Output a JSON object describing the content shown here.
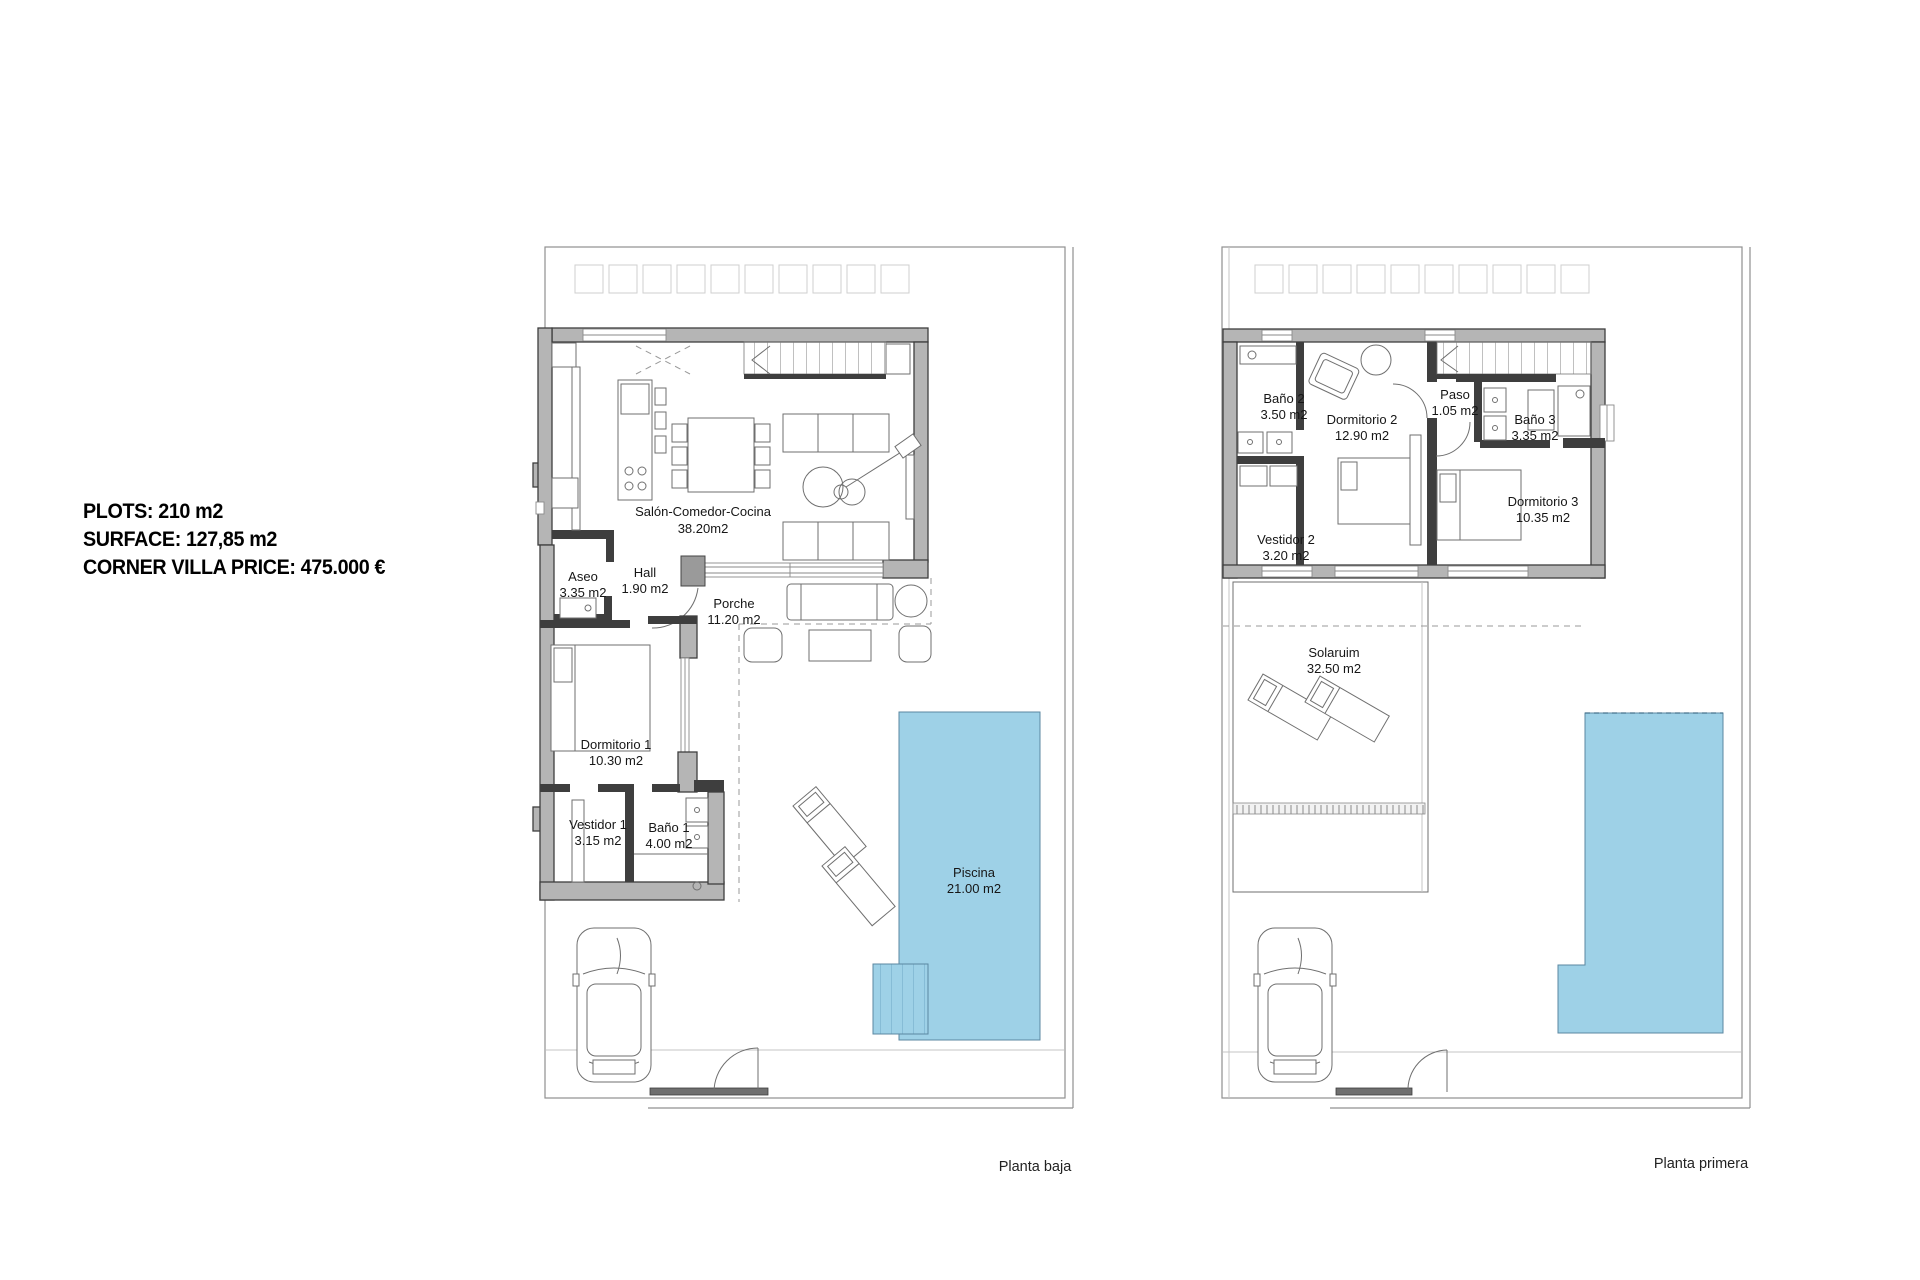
{
  "info": {
    "plots": "PLOTS: 210 m2",
    "surface": "SURFACE: 127,85 m2",
    "price": "CORNER VILLA PRICE: 475.000 €"
  },
  "ground_floor": {
    "caption": "Planta baja",
    "rooms": {
      "salon": {
        "name": "Salón-Comedor-Cocina",
        "area": "38.20m2"
      },
      "aseo": {
        "name": "Aseo",
        "area": "3.35 m2"
      },
      "hall": {
        "name": "Hall",
        "area": "1.90 m2"
      },
      "porche": {
        "name": "Porche",
        "area": "11.20 m2"
      },
      "dormitorio1": {
        "name": "Dormitorio 1",
        "area": "10.30 m2"
      },
      "vestidor1": {
        "name": "Vestidor 1",
        "area": "3.15 m2"
      },
      "bano1": {
        "name": "Baño 1",
        "area": "4.00 m2"
      },
      "piscina": {
        "name": "Piscina",
        "area": "21.00 m2"
      }
    }
  },
  "first_floor": {
    "caption": "Planta primera",
    "rooms": {
      "bano2": {
        "name": "Baño 2",
        "area": "3.50 m2"
      },
      "dormitorio2": {
        "name": "Dormitorio 2",
        "area": "12.90 m2"
      },
      "paso": {
        "name": "Paso",
        "area": "1.05 m2"
      },
      "bano3": {
        "name": "Baño 3",
        "area": "3.35 m2"
      },
      "dormitorio3": {
        "name": "Dormitorio 3",
        "area": "10.35 m2"
      },
      "vestidor2": {
        "name": "Vestidor 2",
        "area": "3.20 m2"
      },
      "solarium": {
        "name": "Solaruim",
        "area": "32.50 m2"
      }
    }
  },
  "colors": {
    "pool": "#9ed1e7",
    "wall": "#b5b5b5",
    "wall_edge": "#3e3e3e"
  }
}
